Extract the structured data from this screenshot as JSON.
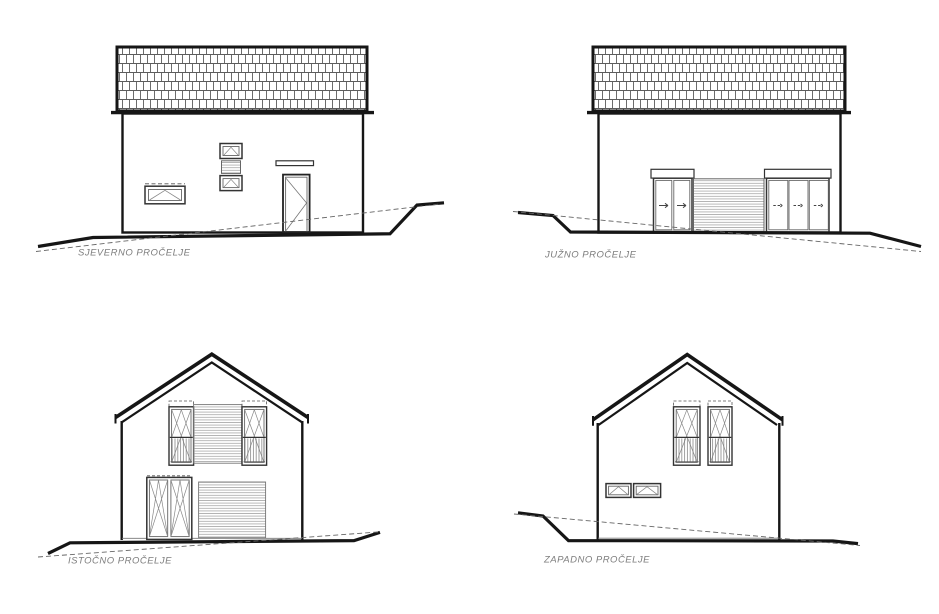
{
  "drawing": {
    "title": "House elevation drawings",
    "colors": {
      "line": "#161616",
      "detail": "#6e6e6e",
      "hatch": "#9a9a9a",
      "label": "#7d7d7d",
      "background": "#ffffff"
    },
    "elevations": [
      {
        "id": "north",
        "label": "SJEVERNO PROČELJE"
      },
      {
        "id": "south",
        "label": "JUŽNO PROČELJE"
      },
      {
        "id": "east",
        "label": "ISTOČNO PROČELJE"
      },
      {
        "id": "west",
        "label": "ZAPADNO PROČELJE"
      }
    ]
  }
}
